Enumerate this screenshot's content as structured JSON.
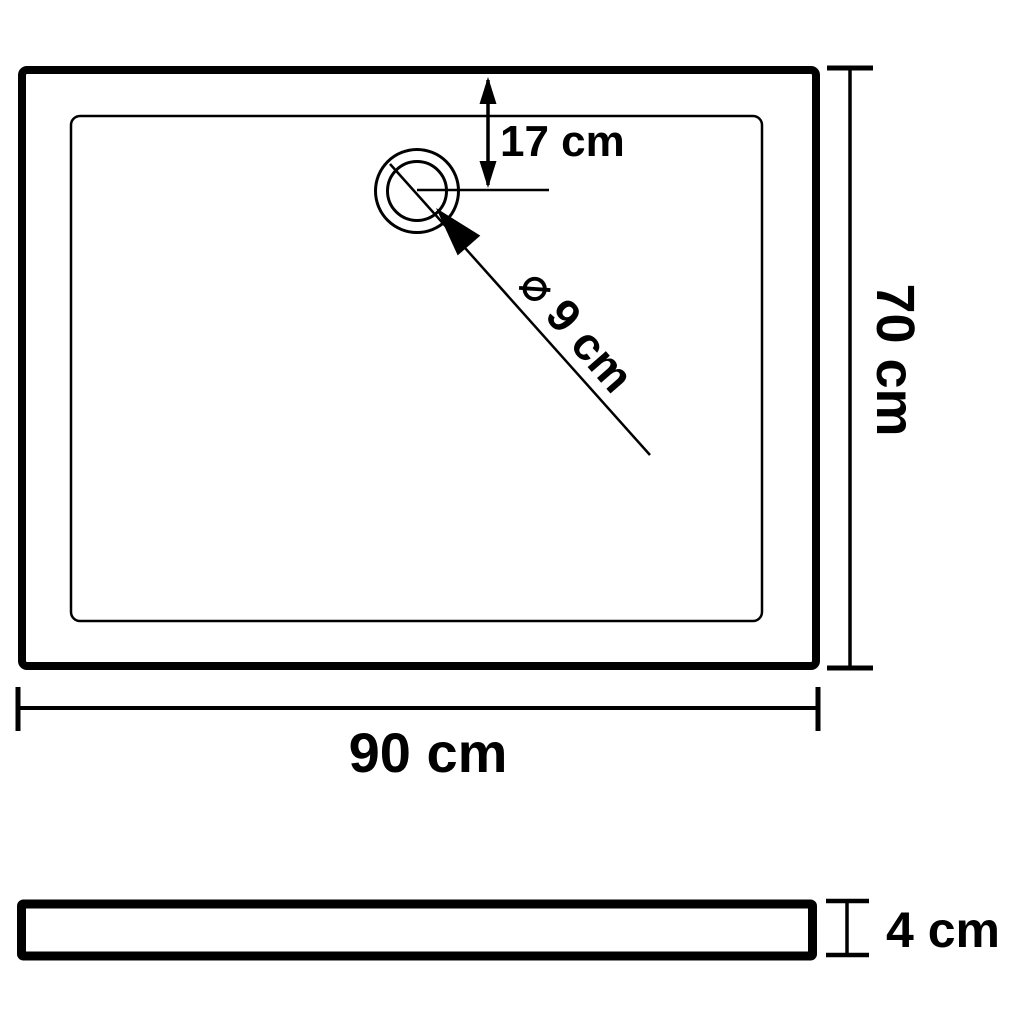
{
  "labels": {
    "drain_offset": "17 cm",
    "drain_diameter": "⌀ 9 cm",
    "side_length": "70 cm",
    "bottom_length": "90 cm",
    "profile_height": "4 cm"
  },
  "colors": {
    "line": "#000000",
    "background": "#ffffff"
  }
}
